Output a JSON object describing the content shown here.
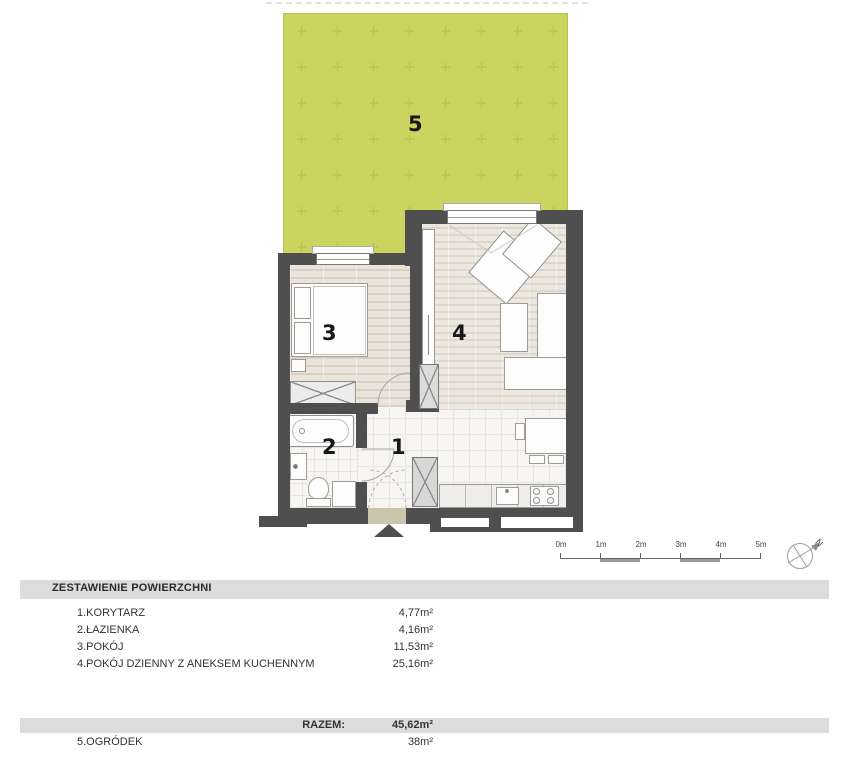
{
  "plan": {
    "room_numbers": {
      "garden": "5",
      "bedroom": "3",
      "living": "4",
      "bathroom": "2",
      "corridor": "1"
    },
    "scale_labels": [
      "0m",
      "1m",
      "2m",
      "3m",
      "4m",
      "5m"
    ],
    "compass_label": "N"
  },
  "summary": {
    "title": "ZESTAWIENIE POWIERZCHNI",
    "rows": [
      {
        "label": "1.KORYTARZ",
        "value": "4,77m²"
      },
      {
        "label": "2.ŁAZIENKA",
        "value": "4,16m²"
      },
      {
        "label": "3.POKÓJ",
        "value": "11,53m²"
      },
      {
        "label": "4.POKÓJ DZIENNY Z ANEKSEM KUCHENNYM",
        "value": "25,16m²"
      }
    ],
    "total_label": "RAZEM:",
    "total_value": "45,62m²",
    "garden_row": {
      "label": "5.OGRÓDEK",
      "value": "38m²"
    }
  },
  "colors": {
    "garden": "#ccd35e",
    "garden_pattern": "#bcc44f",
    "wall": "#4f4f4f",
    "header_bar": "#dcdcdc"
  }
}
